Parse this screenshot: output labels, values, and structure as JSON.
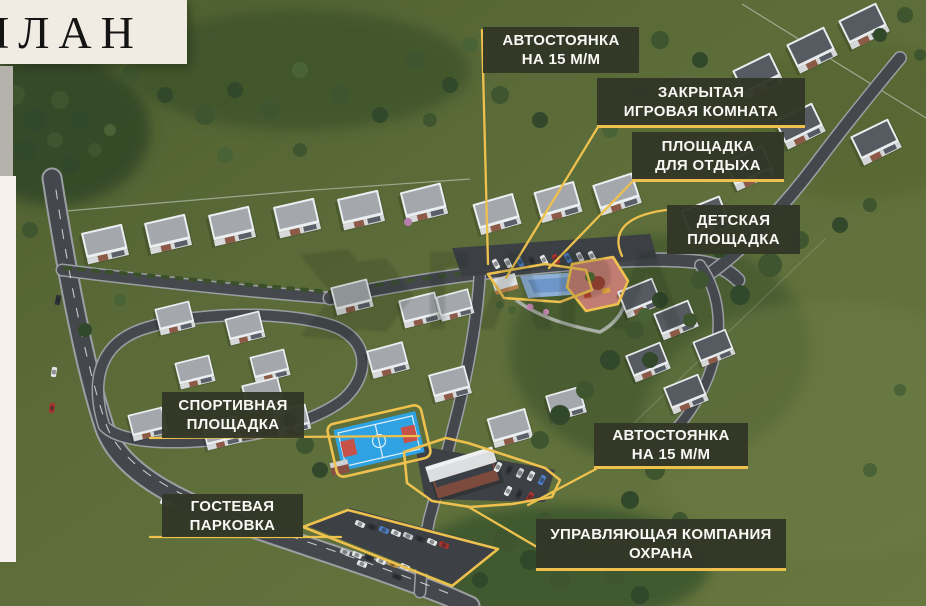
{
  "header": {
    "title": "ПЛАН"
  },
  "map": {
    "callouts": [
      {
        "id": "parking-top",
        "lines": [
          "АВТОСТОЯНКА",
          "НА 15 М/М"
        ]
      },
      {
        "id": "game-room",
        "lines": [
          "ЗАКРЫТАЯ",
          "ИГРОВАЯ КОМНАТА"
        ]
      },
      {
        "id": "rest-area",
        "lines": [
          "ПЛОЩАДКА",
          "ДЛЯ ОТДЫХА"
        ]
      },
      {
        "id": "kids-playground",
        "lines": [
          "ДЕТСКАЯ",
          "ПЛОЩАДКА"
        ]
      },
      {
        "id": "sports-ground",
        "lines": [
          "СПОРТИВНАЯ",
          "ПЛОЩАДКА"
        ]
      },
      {
        "id": "guest-parking",
        "lines": [
          "ГОСТЕВАЯ",
          "ПАРКОВКА"
        ]
      },
      {
        "id": "parking-right",
        "lines": [
          "АВТОСТОЯНКА",
          "НА 15 М/М"
        ]
      },
      {
        "id": "management",
        "lines": [
          "УПРАВЛЯЮЩАЯ КОМПАНИЯ",
          "ОХРАНА"
        ]
      }
    ],
    "colors": {
      "accent_yellow": "#eec14e",
      "callout_bg": "#323627",
      "header_cream": "#f1ece3",
      "grass": "#5d6d3a",
      "road": "#44484d",
      "pool_water": "#8fb0d6",
      "sport_court": "#2ea2e2",
      "playground_ground": "#c27d72"
    }
  }
}
